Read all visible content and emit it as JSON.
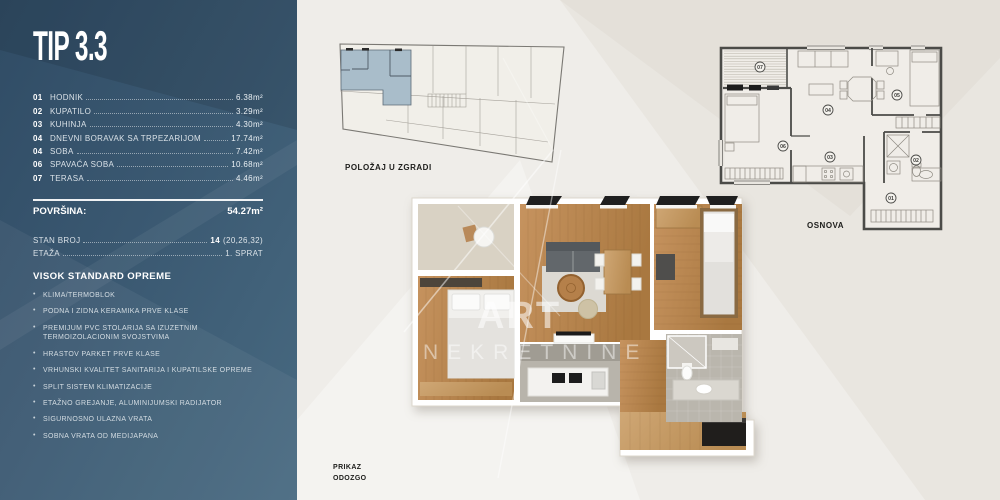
{
  "panel": {
    "title": "TIP 3.3",
    "rooms": [
      {
        "num": "01",
        "name": "HODNIK",
        "area": "6.38m²"
      },
      {
        "num": "02",
        "name": "KUPATILO",
        "area": "3.29m²"
      },
      {
        "num": "03",
        "name": "KUHINJA",
        "area": "4.30m²"
      },
      {
        "num": "04",
        "name": "DNEVNI BORAVAK SA TRPEZARIJOM",
        "area": "17.74m²"
      },
      {
        "num": "04",
        "name": "SOBA",
        "area": "7.42m²"
      },
      {
        "num": "06",
        "name": "SPAVAĆA SOBA",
        "area": "10.68m²"
      },
      {
        "num": "07",
        "name": "TERASA",
        "area": "4.46m²"
      }
    ],
    "total": {
      "label": "POVRŠINA:",
      "value": "54.27m²"
    },
    "stan": {
      "label": "STAN BROJ",
      "value": "14",
      "extra": "(20,26,32)"
    },
    "etaza": {
      "label": "ETAŽA",
      "value": "1. SPRAT"
    },
    "features_title": "VISOK STANDARD OPREME",
    "features": [
      "KLIMA/TERMOBLOK",
      "PODNA I ZIDNA KERAMIKA PRVE KLASE",
      "PREMIJUM PVC STOLARIJA SA IZUZETNIM TERMOIZOLACIONIM SVOJSTVIMA",
      "HRASTOV PARKET PRVE KLASE",
      "VRHUNSKI KVALITET SANITARIJA I KUPATILSKE OPREME",
      "SPLIT SISTEM KLIMATIZACIJE",
      "ETAŽNO GREJANJE, ALUMINIJUMSKI RADIJATOR",
      "SIGURNOSNO ULAZNA VRATA",
      "SOBNA VRATA OD MEDIJAPANA"
    ]
  },
  "captions": {
    "position": "POLOŽAJ U ZGRADI",
    "osnova": "OSNOVA",
    "prikaz_1": "PRIKAZ",
    "prikaz_2": "ODOZGO"
  },
  "watermark": {
    "line1": "ART",
    "line2": "NEKRETNINE"
  },
  "osnova_plan": {
    "room_numbers": [
      "01",
      "02",
      "03",
      "04",
      "05",
      "06",
      "07"
    ]
  },
  "colors": {
    "panel_dark": "#304c65",
    "panel_mid": "#3a5871",
    "panel_light": "#486a81",
    "apartment_highlight": "#a9bdca",
    "background": "#e9e6e0",
    "plan_wall": "#4b4b48",
    "wood_floor": "#bd8a58"
  }
}
